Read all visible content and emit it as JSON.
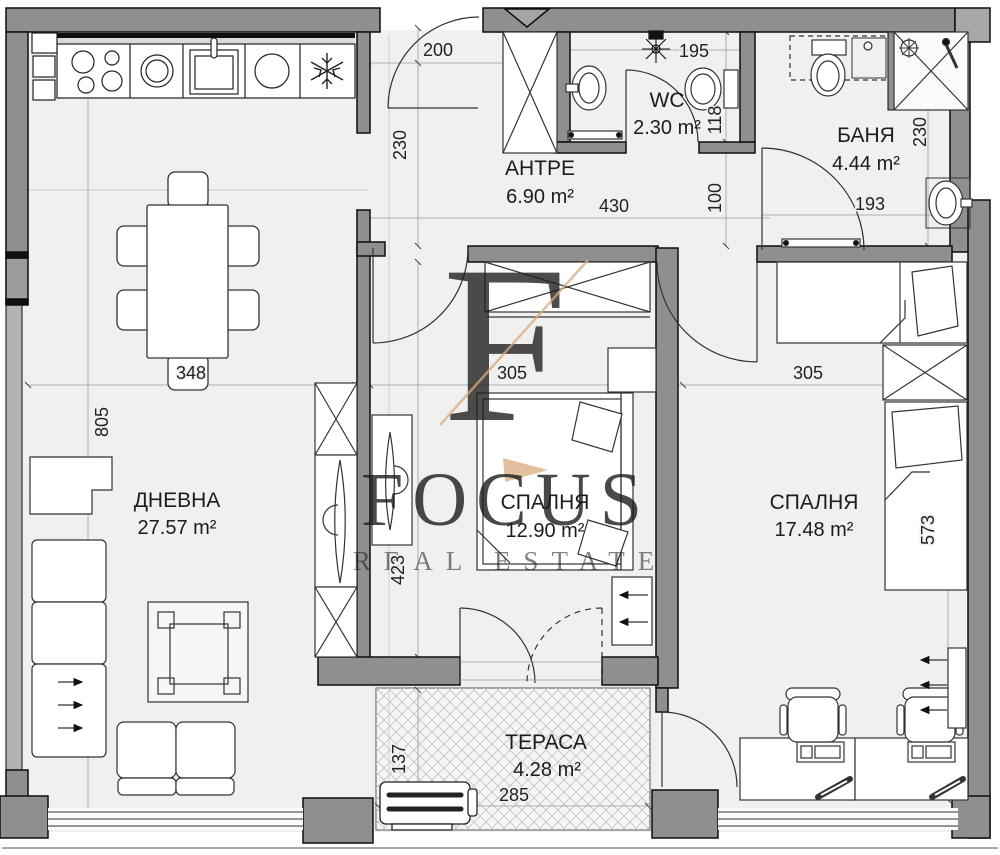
{
  "watermark": {
    "monogram": "F",
    "name": "FOCUS",
    "tagline": "REAL ESTATE",
    "color": "#d9a87c"
  },
  "rooms": {
    "living": {
      "name": "ДНЕВНА",
      "area": "27.57 m²"
    },
    "bedroom1": {
      "name": "СПАЛНЯ",
      "area": "12.90 m²"
    },
    "bedroom2": {
      "name": "СПАЛНЯ",
      "area": "17.48 m²"
    },
    "hall": {
      "name": "АНТРЕ",
      "area": "6.90 m²"
    },
    "wc": {
      "name": "WC",
      "area": "2.30 m²"
    },
    "bath": {
      "name": "БАНЯ",
      "area": "4.44 m²"
    },
    "terrace": {
      "name": "ТЕРАСА",
      "area": "4.28 m²"
    }
  },
  "dimensions": {
    "d200": "200",
    "d230_hall": "230",
    "d195": "195",
    "d118": "118",
    "d230_bath": "230",
    "d193": "193",
    "d430": "430",
    "d100": "100",
    "d348": "348",
    "d305_b1": "305",
    "d305_b2": "305",
    "d805": "805",
    "d423": "423",
    "d573": "573",
    "d137": "137",
    "d285": "285"
  },
  "colors": {
    "wall": "#8f8f8f",
    "wall_light": "#aeaeae",
    "floor": "#f0f0f0",
    "line": "#2a2a2a"
  }
}
